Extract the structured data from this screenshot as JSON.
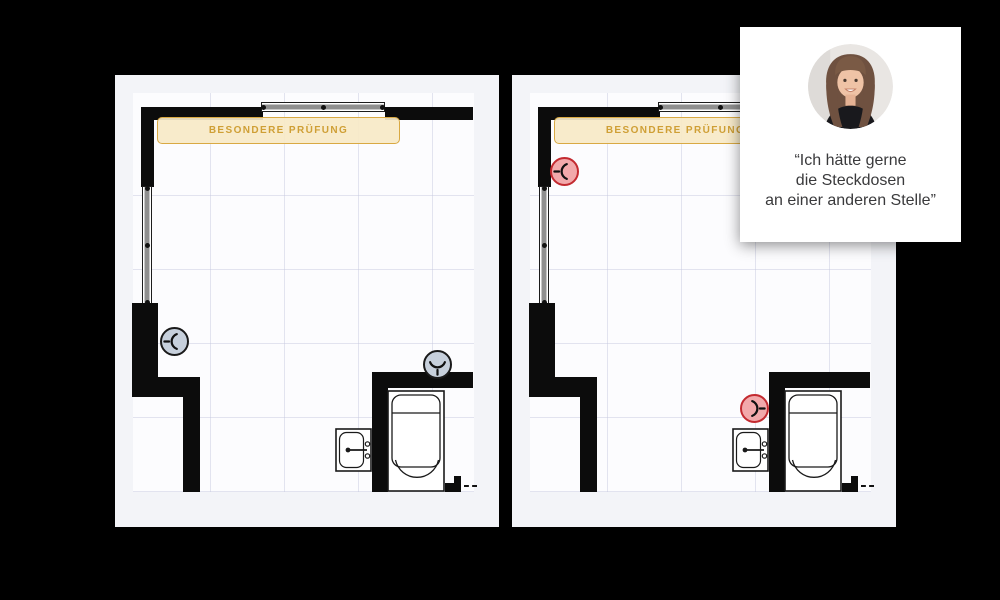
{
  "scene": {
    "background": "#000000"
  },
  "plans": [
    {
      "name": "floorplan-before",
      "banner": {
        "label": "BESONDERE PRÜFUNG"
      },
      "sockets": [
        {
          "id": "socket-left-wall",
          "state": "neutral",
          "fill": "#c7d0dc",
          "border": "#1a1a1a",
          "orientation": "stem-left"
        },
        {
          "id": "socket-bath-wall",
          "state": "neutral",
          "fill": "#c7d0dc",
          "border": "#1a1a1a",
          "orientation": "stem-down"
        }
      ]
    },
    {
      "name": "floorplan-after",
      "banner": {
        "label": "BESONDERE PRÜFUNG"
      },
      "sockets": [
        {
          "id": "socket-left-wall-top",
          "state": "highlight",
          "fill": "#f2a9ab",
          "border": "#c32a30",
          "orientation": "stem-left"
        },
        {
          "id": "socket-near-sink",
          "state": "highlight",
          "fill": "#f2a9ab",
          "border": "#c32a30",
          "orientation": "stem-right"
        }
      ]
    }
  ],
  "quote_card": {
    "avatar": "customer-portrait",
    "line1": "“Ich hätte gerne",
    "line2": "die Steckdosen",
    "line3": "an einer anderen Stelle”"
  },
  "palette": {
    "banner_bg": "#f7e9c7",
    "banner_border": "#d9a943",
    "banner_text": "#cf9f35",
    "wall": "#0c0c0c",
    "grid_line": "#c4c6de",
    "plan_bg": "#fcfcfe",
    "card_bg": "#f3f4f8",
    "quote_bg": "#ffffff",
    "quote_text": "#3a3a3c"
  }
}
